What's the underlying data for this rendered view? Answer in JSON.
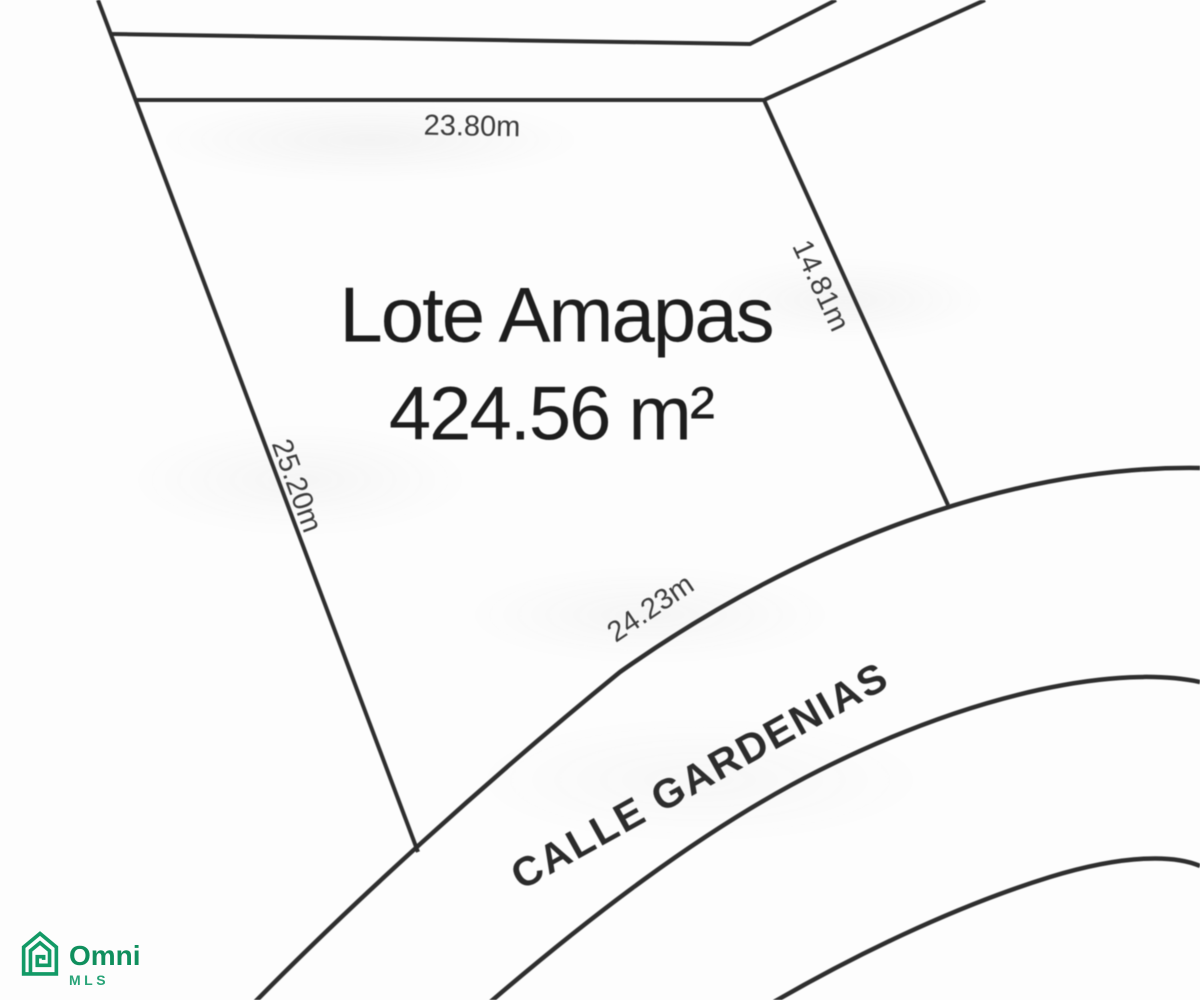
{
  "map": {
    "lot": {
      "name": "Lote Amapas",
      "area": "424.56 m²",
      "dim_top": "23.80m",
      "dim_right": "14.81m",
      "dim_left": "25.20m",
      "dim_frontage": "24.23m"
    },
    "street": {
      "name": "CALLE GARDENIAS"
    },
    "colors": {
      "line": "#2e2e2e",
      "text": "#1d1d1d",
      "background": "#fdfdfd"
    }
  },
  "logo": {
    "brand": "Omni",
    "sub_brand": "MLS",
    "icon": "omni-house-spiral-icon",
    "color_primary": "#0f8f5d",
    "color_secondary": "#29a478"
  }
}
